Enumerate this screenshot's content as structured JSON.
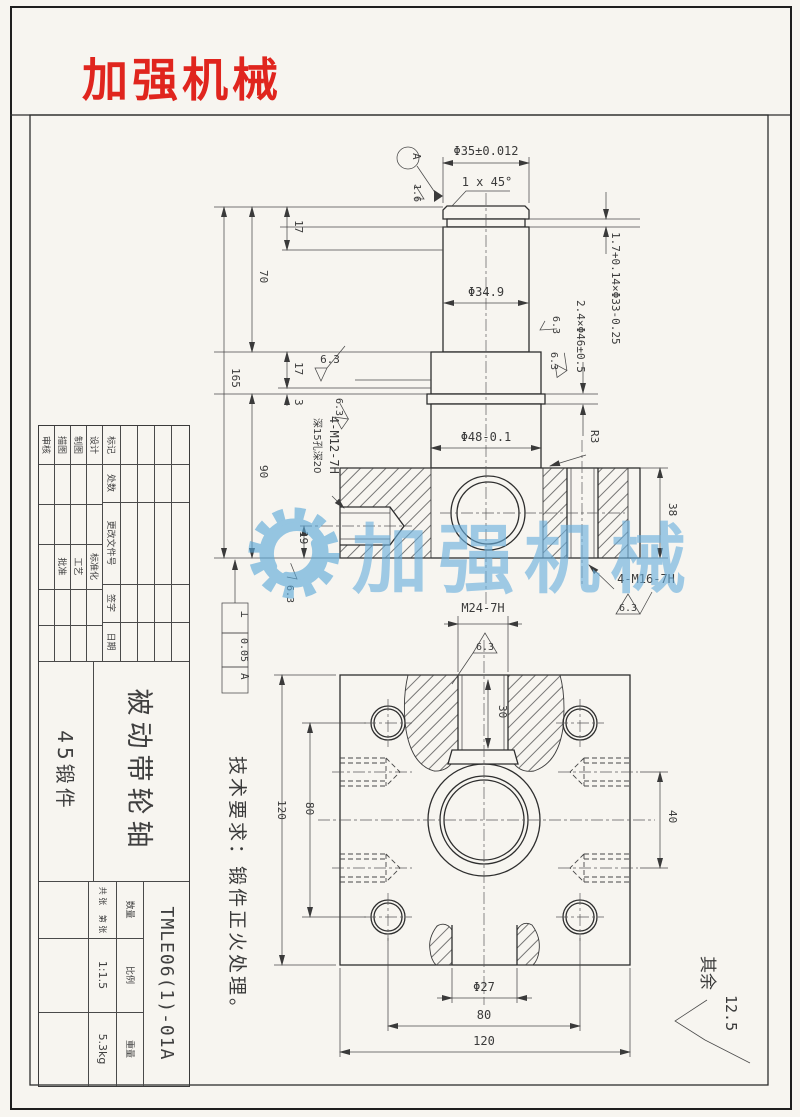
{
  "page": {
    "logo": "加强机械"
  },
  "watermark": {
    "text": "加强机械",
    "color": "#68aedd"
  },
  "notes": {
    "tech_req": "技术要求：锻件正火处理。",
    "rest_label": "其余",
    "rest_value": "12.5"
  },
  "upper_view": {
    "datum": "A",
    "d35": "Φ35±0.012",
    "chamfer": "1 x 45°",
    "fin16": "1.6",
    "fin63": "6.3",
    "d349": "Φ34.9",
    "groove": "1.7+0.14×Φ33-0.25",
    "collar": "2.4×Φ46±0.5",
    "d48": "Φ48-0.1",
    "r3": "R3",
    "h38": "38",
    "m16": "4-M16-7H",
    "m12": "4-M12-7H",
    "m12_depth": "深15孔深20",
    "len17": "17",
    "len70": "70",
    "len3": "3",
    "len165": "165",
    "len90": "90",
    "len19": "19",
    "tol_sym": "⊥",
    "tol_val": "0.05",
    "tol_ref": "A",
    "m24": "M24-7H"
  },
  "lower_view": {
    "depth30": "30",
    "h120": "120",
    "h80": "80",
    "s40": "40",
    "d27": "Φ27",
    "w80": "80",
    "w120": "120"
  },
  "title_block": {
    "rev_headers": [
      "标记",
      "处数",
      "更改文件号",
      "签字",
      "日期"
    ],
    "roles": [
      "设计",
      "制图",
      "描图",
      "审核"
    ],
    "approvals": [
      "标准化",
      "工艺",
      "批准"
    ],
    "part_name": "被动带轮轴",
    "material": "45锻件",
    "drawing_no": "TMLE06(1)-01A",
    "qty_label": "数量",
    "scale_label": "比例",
    "weight_label": "重量",
    "scale_value": "1:1.5",
    "weight_value": "5.3kg",
    "sheet_total": "共 张",
    "sheet_no": "第 张"
  }
}
